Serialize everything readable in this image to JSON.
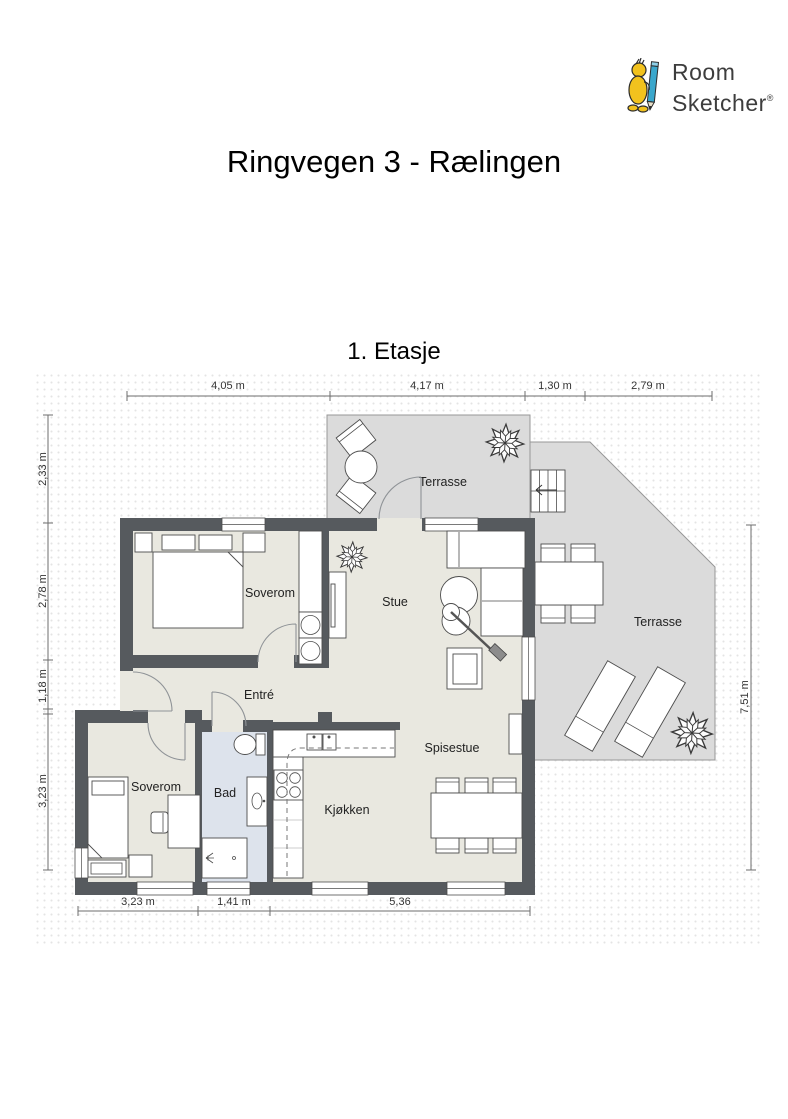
{
  "logo": {
    "line1": "Room",
    "line2": "Sketcher",
    "registered": "®"
  },
  "title": "Ringvegen 3 - Rælingen",
  "floor_label": "1. Etasje",
  "rooms": {
    "bedroom1": "Soverom",
    "living": "Stue",
    "entry": "Entré",
    "bedroom2": "Soverom",
    "bath": "Bad",
    "kitchen": "Kjøkken",
    "dining": "Spisestue",
    "terrace_top": "Terrasse",
    "terrace_right": "Terrasse"
  },
  "dimensions": {
    "top": [
      "4,05 m",
      "4,17 m",
      "1,30 m",
      "2,79 m"
    ],
    "left": [
      "2,33 m",
      "2,78 m",
      "1,18 m",
      "3,23 m"
    ],
    "right": [
      "7,51 m"
    ],
    "bottom": [
      "3,23 m",
      "1,41 m",
      "5,36"
    ]
  },
  "colors": {
    "wall": "#565a5e",
    "floor": "#e9e8e0",
    "bath_floor": "#dde3ec",
    "terrace": "#dbdbdb",
    "logo_yellow": "#f2c21e",
    "logo_blue": "#3aa7cc",
    "logo_text": "#3d3d3d"
  }
}
